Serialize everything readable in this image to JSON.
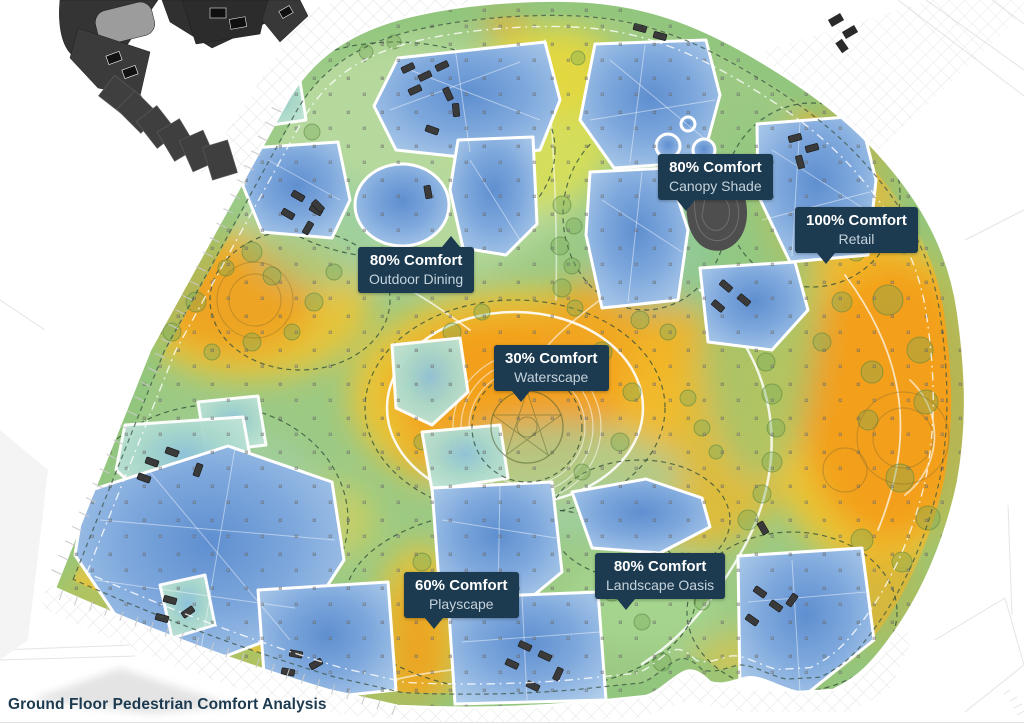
{
  "title": "Ground Floor Pedestrian Comfort Analysis",
  "callouts": [
    {
      "id": "canopy-shade",
      "value": "80% Comfort",
      "label": "Canopy Shade",
      "x": 658,
      "y": 154,
      "pointer": "bottom",
      "pointer_offset": "24%"
    },
    {
      "id": "retail",
      "value": "100% Comfort",
      "label": "Retail",
      "x": 795,
      "y": 207,
      "pointer": "bottom",
      "pointer_offset": "25%"
    },
    {
      "id": "outdoor-dining",
      "value": "80% Comfort",
      "label": "Outdoor Dining",
      "x": 358,
      "y": 247,
      "pointer": "top",
      "pointer_offset": "80%"
    },
    {
      "id": "waterscape",
      "value": "30% Comfort",
      "label": "Waterscape",
      "x": 494,
      "y": 345,
      "pointer": "bottom",
      "pointer_offset": "24%"
    },
    {
      "id": "playscape",
      "value": "60% Comfort",
      "label": "Playscape",
      "x": 404,
      "y": 572,
      "pointer": "bottom",
      "pointer_offset": "26%"
    },
    {
      "id": "landscape-oasis",
      "value": "80% Comfort",
      "label": "Landscape Oasis",
      "x": 595,
      "y": 553,
      "pointer": "bottom",
      "pointer_offset": "24%"
    }
  ],
  "colors": {
    "callout_bg": "#1c3a50",
    "callout_value": "#ffffff",
    "callout_label": "#c5d3db",
    "title_text": "#1c3a50",
    "heat_hot": "#f49d15",
    "heat_warm": "#f4c32a",
    "heat_moderate_green": "#9ccb83",
    "heat_cool_teal": "#bfe3d1",
    "comfortable_blue": "#7da7dc"
  }
}
